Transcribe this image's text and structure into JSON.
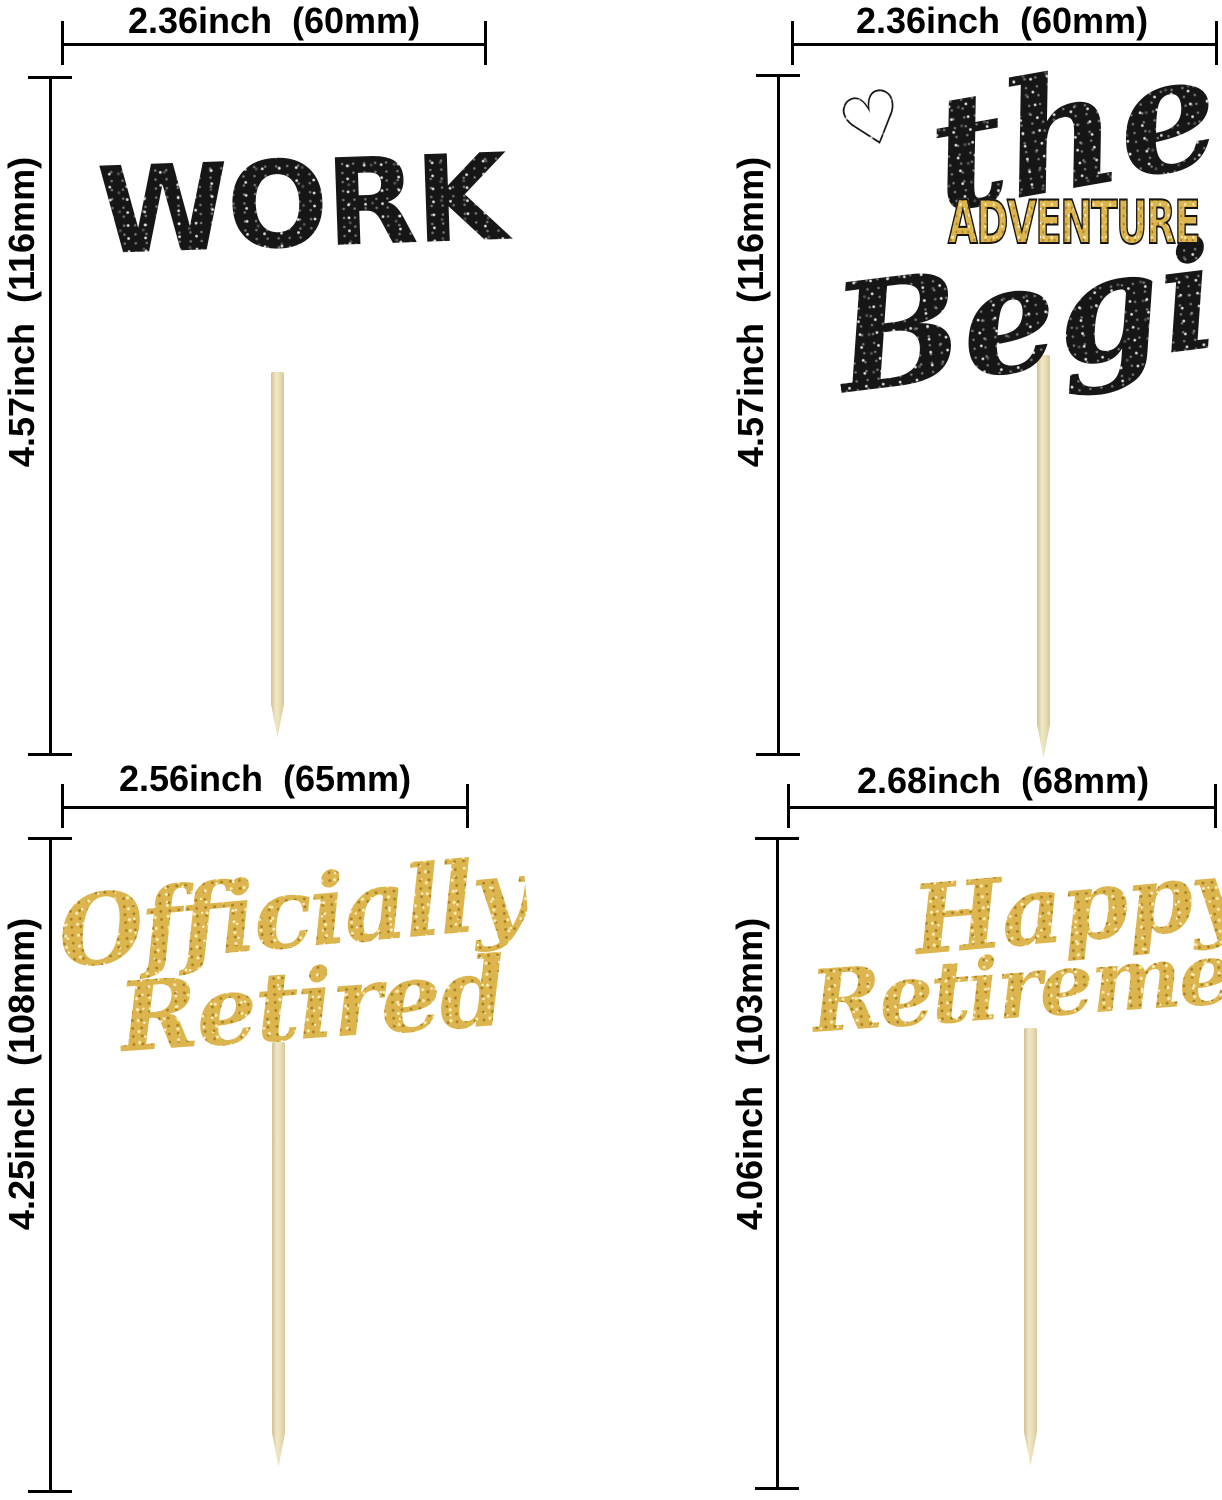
{
  "toppers": {
    "no_work_zone": {
      "width_label": "2.36inch  (60mm)",
      "height_label": "4.57inch  (116mm)",
      "line1": "NO",
      "line2": "WORK",
      "line3": "ZONE"
    },
    "adventure_begins": {
      "width_label": "2.36inch  (60mm)",
      "height_label": "4.57inch  (116mm)",
      "heart": "♡",
      "line1": "the",
      "line2": "ADVENTURE",
      "line3": "Begins"
    },
    "officially_retired": {
      "width_label": "2.56inch  (65mm)",
      "height_label": "4.25inch  (108mm)",
      "line1": "Officially",
      "line2": "Retired"
    },
    "happy_retirement": {
      "width_label": "2.68inch  (68mm)",
      "height_label": "4.06inch  (103mm)",
      "line1": "Happy",
      "line2": "Retirement"
    }
  },
  "colors": {
    "black_glitter": "#161616",
    "gold_glitter": "#dcb54e",
    "stick_wood": "#e9dfb6",
    "dimension_lines": "#000000",
    "background": "#ffffff"
  }
}
